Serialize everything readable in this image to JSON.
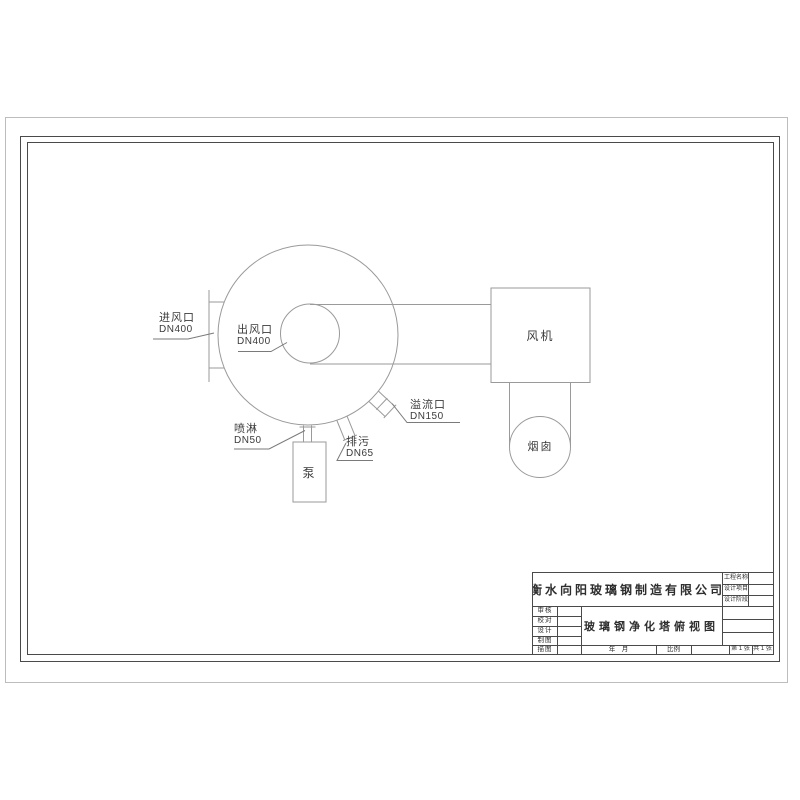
{
  "drawing": {
    "inlet": {
      "label": "进风口",
      "dn": "DN400"
    },
    "outlet": {
      "label": "出风口",
      "dn": "DN400"
    },
    "spray": {
      "label": "喷淋",
      "dn": "DN50"
    },
    "drain": {
      "label": "排污",
      "dn": "DN65"
    },
    "overflow": {
      "label": "溢流口",
      "dn": "DN150"
    },
    "pump_label": "泵",
    "fan_label": "风机",
    "chimney_label": "烟囱"
  },
  "title_block": {
    "company": "衡水向阳玻璃钢制造有限公司",
    "drawing_title": "玻璃钢净化塔俯视图",
    "project_fields": [
      "工程名称",
      "设计项目",
      "设计阶段"
    ],
    "role_fields": [
      "审核",
      "校对",
      "设计",
      "制图",
      "描图"
    ],
    "date_label": "年　月",
    "scale_label": "比例",
    "sheet_number": "第 1 张",
    "sheet_total": "共 1 张"
  },
  "colors": {
    "sheet_border": "#bdbdbd",
    "frame_line": "#4a4a4a",
    "drawing_line": "#9a9a9a",
    "text": "#3b3b3b"
  }
}
